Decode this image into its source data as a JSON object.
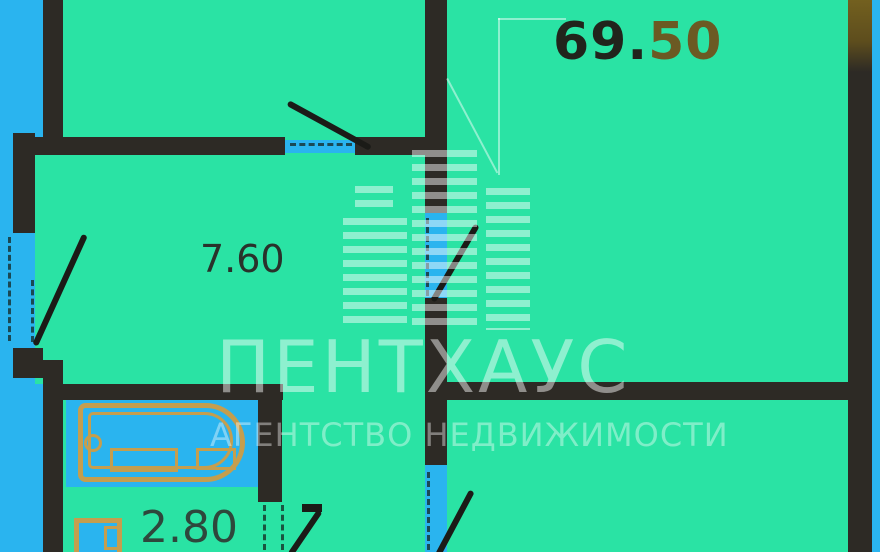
{
  "labels": {
    "total_area_int": "69.",
    "total_area_frac": "50",
    "hallway_area": "7.60",
    "bath_hall_area": "2.80"
  },
  "watermark": {
    "title": "ПЕНТХАУС",
    "subtitle": "АГЕНТСТВО НЕДВИЖИМОСТИ",
    "logo": "skyscraper-stripes-icon"
  },
  "colors": {
    "outside": "#2ab4ef",
    "floor": "#2ae3a4",
    "wall": "#2d2a25",
    "fixture": "#c59e4e",
    "leaf": "#1b1b17",
    "wall_top_right_accent": "#6e5b20",
    "total_int_color": "#21241c",
    "total_frac_color": "#6b5a23"
  }
}
